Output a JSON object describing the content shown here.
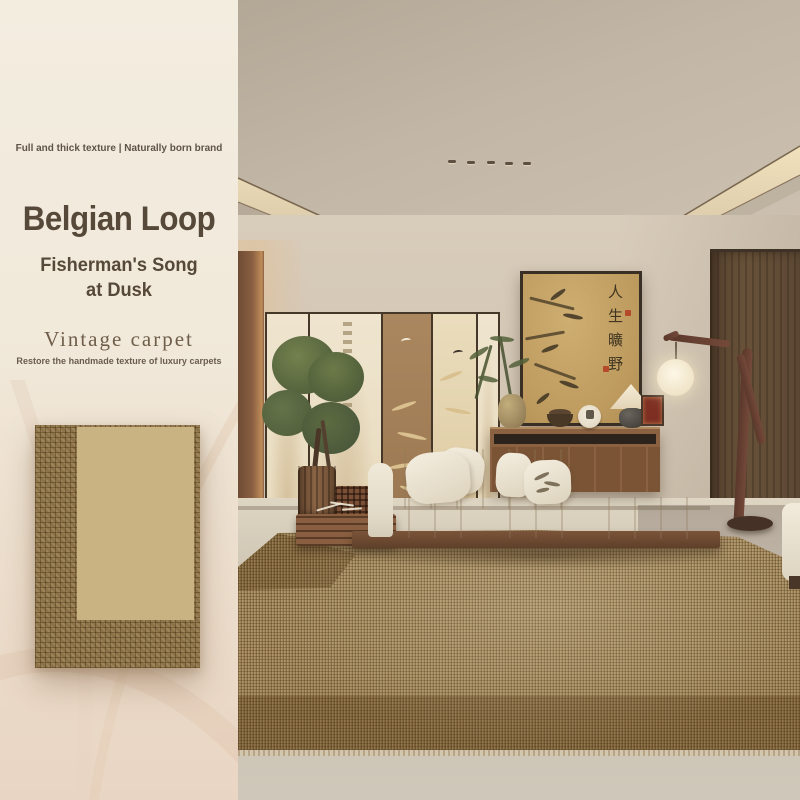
{
  "poster": {
    "tagline": "Full and thick texture | Naturally born brand",
    "title": "Belgian Loop",
    "subtitle": "Fisherman's Song at Dusk",
    "collection": "Vintage carpet",
    "collection_desc": "Restore the handmade texture of luxury carpets"
  },
  "room": {
    "artwork_calligraphy": "人生曠野"
  },
  "colors": {
    "sidebar_bg_top": "#f3ede0",
    "sidebar_bg_bottom": "#e9d5c3",
    "title_text": "#564939",
    "swatch_border": "#8d7347",
    "swatch_field": "#c9b383",
    "ceiling": "#b9ad9e",
    "cove_glow": "#eedfbd",
    "wall": "#d3c7b6",
    "wood_door": "#5f4b37",
    "cabinet_wood": "#8a6141",
    "sofa_cream": "#ece5d4",
    "carpet_field": "#ae9366",
    "carpet_border": "#8a6e44",
    "carpet_binding": "#eae0cb",
    "floor": "#cfc8ba"
  }
}
